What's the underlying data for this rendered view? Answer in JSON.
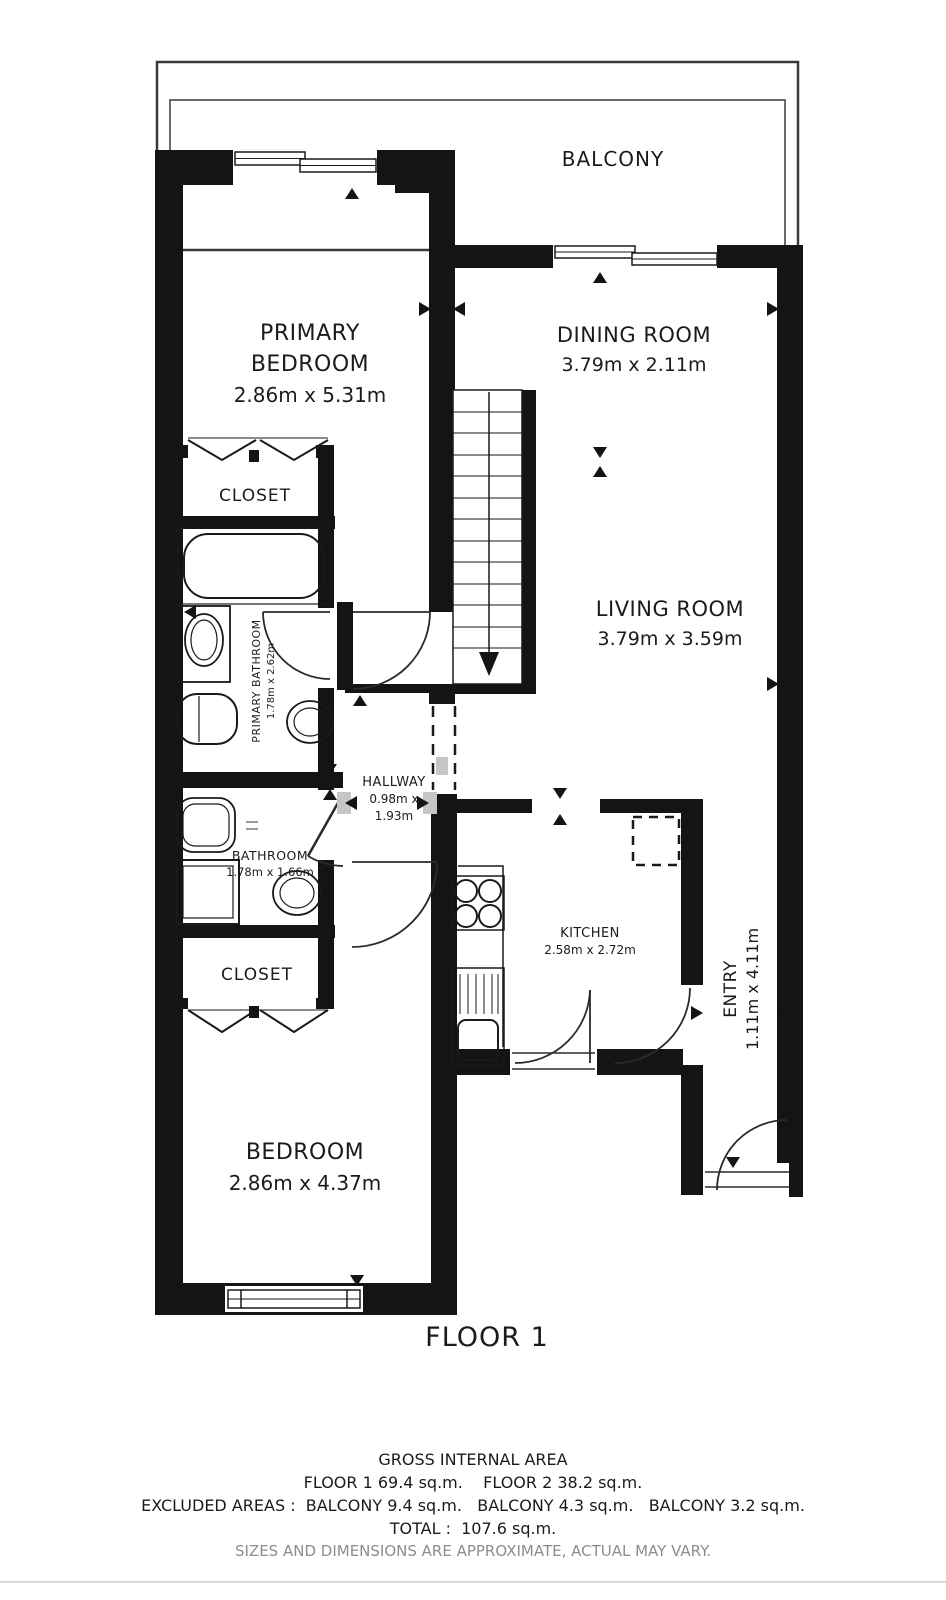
{
  "plan": {
    "balcony": {
      "name": "BALCONY"
    },
    "rooms": {
      "primary_bedroom": {
        "name": "PRIMARY BEDROOM",
        "dims": "2.86m x 5.31m"
      },
      "dining_room": {
        "name": "DINING ROOM",
        "dims": "3.79m x 2.11m"
      },
      "living_room": {
        "name": "LIVING ROOM",
        "dims": "3.79m x 3.59m"
      },
      "closet_upper": {
        "name": "CLOSET"
      },
      "primary_bathroom": {
        "name": "PRIMARY BATHROOM",
        "dims": "1.78m x 2.62m"
      },
      "hallway": {
        "name": "HALLWAY",
        "dims_line1": "0.98m x",
        "dims_line2": "1.93m"
      },
      "bathroom": {
        "name": "BATHROOM",
        "dims": "1.78m x 1.66m"
      },
      "kitchen": {
        "name": "KITCHEN",
        "dims": "2.58m x 2.72m"
      },
      "entry": {
        "name": "ENTRY",
        "dims": "1.11m x 4.11m"
      },
      "closet_lower": {
        "name": "CLOSET"
      },
      "bedroom": {
        "name": "BEDROOM",
        "dims": "2.86m x 4.37m"
      }
    },
    "floor_label": "FLOOR 1"
  },
  "footer": {
    "title": "GROSS INTERNAL AREA",
    "floors": "FLOOR 1 69.4 sq.m.    FLOOR 2 38.2 sq.m.",
    "excluded": "EXCLUDED AREAS :  BALCONY 9.4 sq.m.   BALCONY 4.3 sq.m.   BALCONY 3.2 sq.m.",
    "total": "TOTAL :  107.6 sq.m.",
    "disclaimer": "SIZES AND DIMENSIONS ARE APPROXIMATE, ACTUAL MAY VARY."
  },
  "colors": {
    "wall": "#141414",
    "line": "#222222",
    "muted_text": "#8d8d8d",
    "marker_gray": "#c6c6c6"
  }
}
